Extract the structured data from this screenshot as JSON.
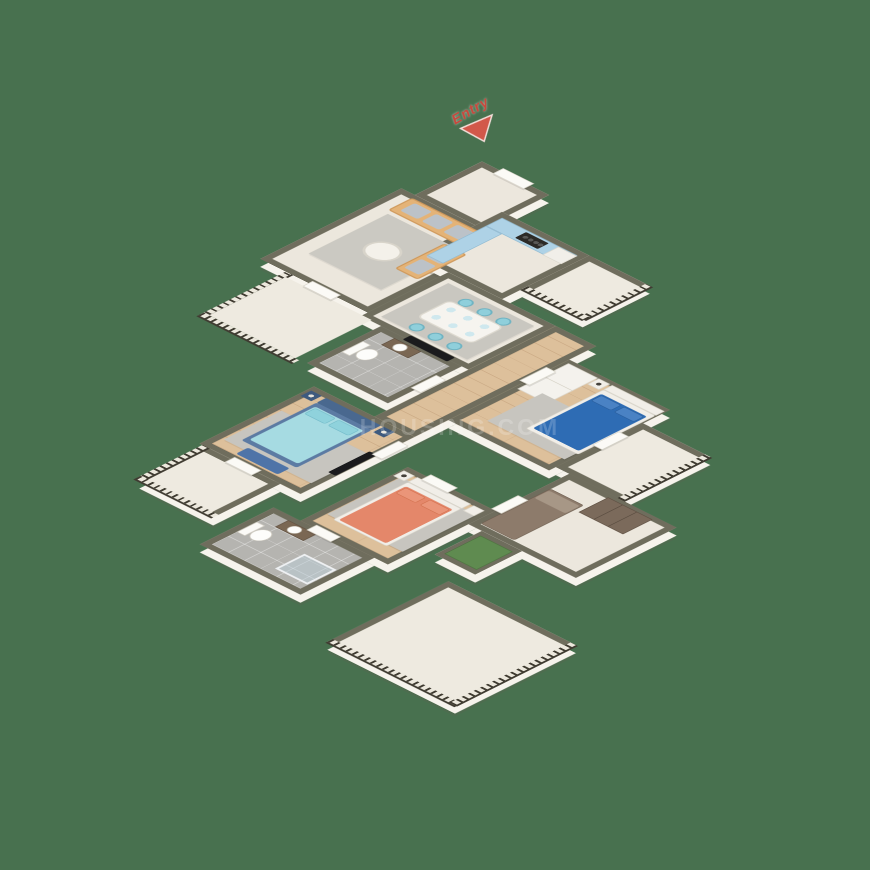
{
  "scene": {
    "type": "3d-isometric-floor-plan",
    "description": "3BHK apartment 3D floor plan render, viewed isometrically on a plain green background",
    "background_color": "#48714F"
  },
  "entry_marker": {
    "label": "Entry",
    "color": "#C9473C",
    "shape": "red-triangle-arrow pointing to entry door"
  },
  "watermark": {
    "text": "HOUSING.COM",
    "color": "rgba(255,255,255,0.2)"
  },
  "palette": {
    "wall_top": "#6F6D5D",
    "wall_face": "#F6F3EC",
    "floor_cream": "#ECE7DD",
    "floor_wood": "#DDC09B",
    "floor_tile_gray": "#B5B4B0",
    "rug_gray": "#C7C5BF",
    "sofa_tan": "#E4B377",
    "kitchen_counter_blue": "#AED2E6",
    "dining_chair_cyan": "#8FCFDB",
    "master_bed_blue": "#2E6CB4",
    "second_bed_cyan": "#A6DBE2",
    "second_bed_frame_navy": "#5C7BA3",
    "third_bed_coral": "#E4876A",
    "study_furniture_brown": "#8D7B6B",
    "grass_mat_green": "#5F8B50",
    "railing_dark": "#3F3B31"
  },
  "floorplan": {
    "rooms": [
      {
        "name": "entry-foyer",
        "floor": "cream"
      },
      {
        "name": "living-room",
        "floor": "cream",
        "furniture": [
          "3-seat tan sofa",
          "2-seat tan sofa",
          "round coffee table",
          "gray rug"
        ]
      },
      {
        "name": "kitchen",
        "floor": "cream",
        "furniture": [
          "L-shaped blue counter",
          "hob",
          "chimney",
          "tall unit"
        ]
      },
      {
        "name": "utility-balcony",
        "floor": "cream",
        "railing": true
      },
      {
        "name": "dining-area",
        "floor": "cream",
        "furniture": [
          "white dining table",
          "6 cyan chairs",
          "gray rug"
        ]
      },
      {
        "name": "common-bathroom",
        "floor": "gray-tile",
        "furniture": [
          "toilet",
          "vanity sink",
          "wall TV outside"
        ]
      },
      {
        "name": "corridor",
        "floor": "wood"
      },
      {
        "name": "master-bedroom",
        "floor": "wood",
        "furniture": [
          "double bed dark blue",
          "white wardrobe",
          "nightstands",
          "gray rug"
        ]
      },
      {
        "name": "master-balcony",
        "floor": "cream",
        "railing": true
      },
      {
        "name": "second-bedroom",
        "floor": "wood",
        "furniture": [
          "double bed cyan/navy",
          "nightstands",
          "blue bench",
          "wall TV",
          "gray rug"
        ]
      },
      {
        "name": "second-bedroom-balcony",
        "floor": "cream",
        "railing": true
      },
      {
        "name": "third-bedroom",
        "floor": "wood",
        "furniture": [
          "double bed coral",
          "nightstands",
          "gray rug"
        ]
      },
      {
        "name": "attached-bathroom",
        "floor": "gray-tile",
        "furniture": [
          "toilet",
          "vanity sink",
          "glass shower"
        ]
      },
      {
        "name": "study-room",
        "floor": "cream",
        "furniture": [
          "brown single bed",
          "brown wardrobe"
        ]
      },
      {
        "name": "green-mat-utility",
        "floor": "cream",
        "furniture": [
          "green mat"
        ]
      },
      {
        "name": "large-bottom-balcony",
        "floor": "cream",
        "railing": true
      }
    ]
  }
}
